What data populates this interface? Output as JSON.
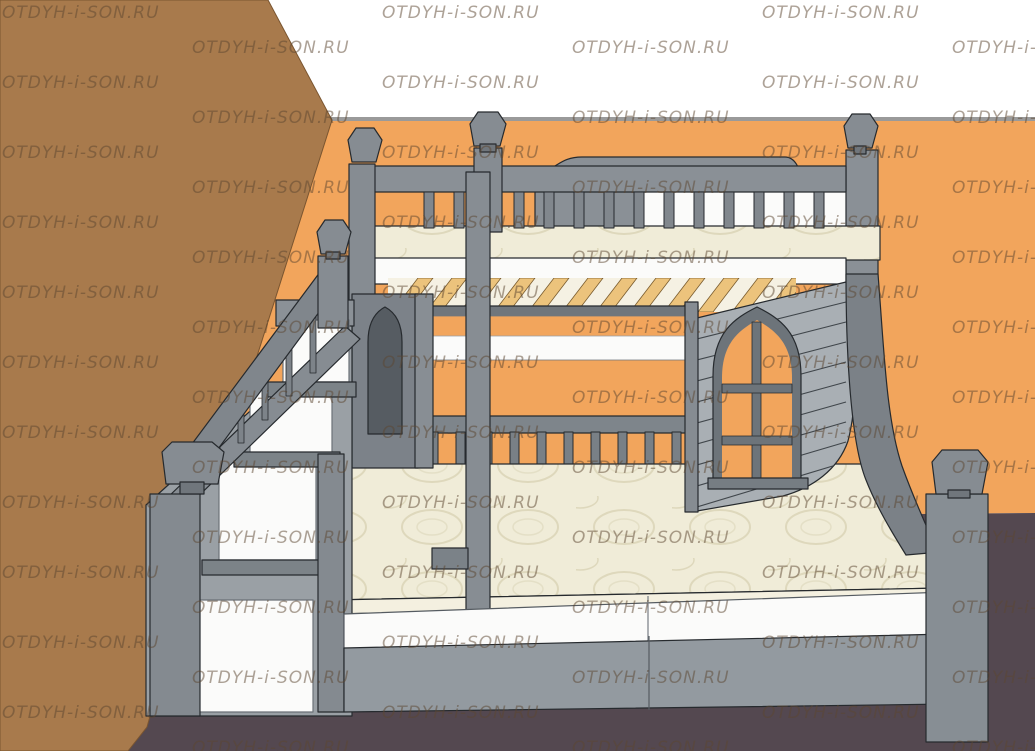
{
  "image": {
    "kind": "3d-render-product-visualization",
    "subject": "children bunk bed with staircase, ladder and playhouse arched window in an orange room",
    "width_px": 1035,
    "height_px": 751
  },
  "watermark": {
    "text": "OTDYH-i-SON.RU",
    "rows": 22,
    "base_y": 18,
    "row_height": 35,
    "col_width": 380,
    "even_row_x": 2,
    "odd_row_x": 192,
    "color": "rgba(92,70,47,0.5)"
  },
  "palette": {
    "wall_orange": "#f2a55c",
    "wall_brown": "#a87a4c",
    "wall_edge_brown": "#7a5530",
    "floor_dark": "#544850",
    "ceiling_white": "#ffffff",
    "wall_top_line": "#9a9a9a",
    "gray_light": "#a9afb4",
    "gray_mid": "#8a9096",
    "gray_mid2": "#868c92",
    "gray_dark": "#70767c",
    "gray_deep": "#5a6066",
    "gray_rail": "#7e858b",
    "gray_base": "#939aa0",
    "panel_white": "#fbfbfa",
    "mattress_cream": "#f0ecd8",
    "mattress_line": "#ded8bc",
    "mattress_side": "#f4f0e0",
    "slat_tan": "#ecc37c",
    "slat_edge": "#7a5c2e",
    "window_frame": "#6d747a",
    "arch_inner": "#565c62",
    "outline": "#262a2e"
  },
  "scene": {
    "counts": {
      "upper_rail_balusters": 14,
      "lower_rail_balusters": 11,
      "slats": 12,
      "gable_plank_lines": 9,
      "stair_balusters": 5
    },
    "elements": [
      "brown-side-wall",
      "orange-back-wall",
      "white-ceiling-band",
      "dark-floor",
      "upper-bunk",
      "curved-headboard-crest",
      "upper-guard-rail",
      "upper-mattress",
      "bed-slats",
      "gothic-window",
      "playhouse-gable",
      "curved-side-panel",
      "lower-bunk",
      "lower-guard-rail",
      "lower-mattress",
      "drawer-fronts",
      "staircase",
      "stair-handrail",
      "stair-steps",
      "newel-posts",
      "finials",
      "ladder",
      "bed-posts"
    ]
  }
}
